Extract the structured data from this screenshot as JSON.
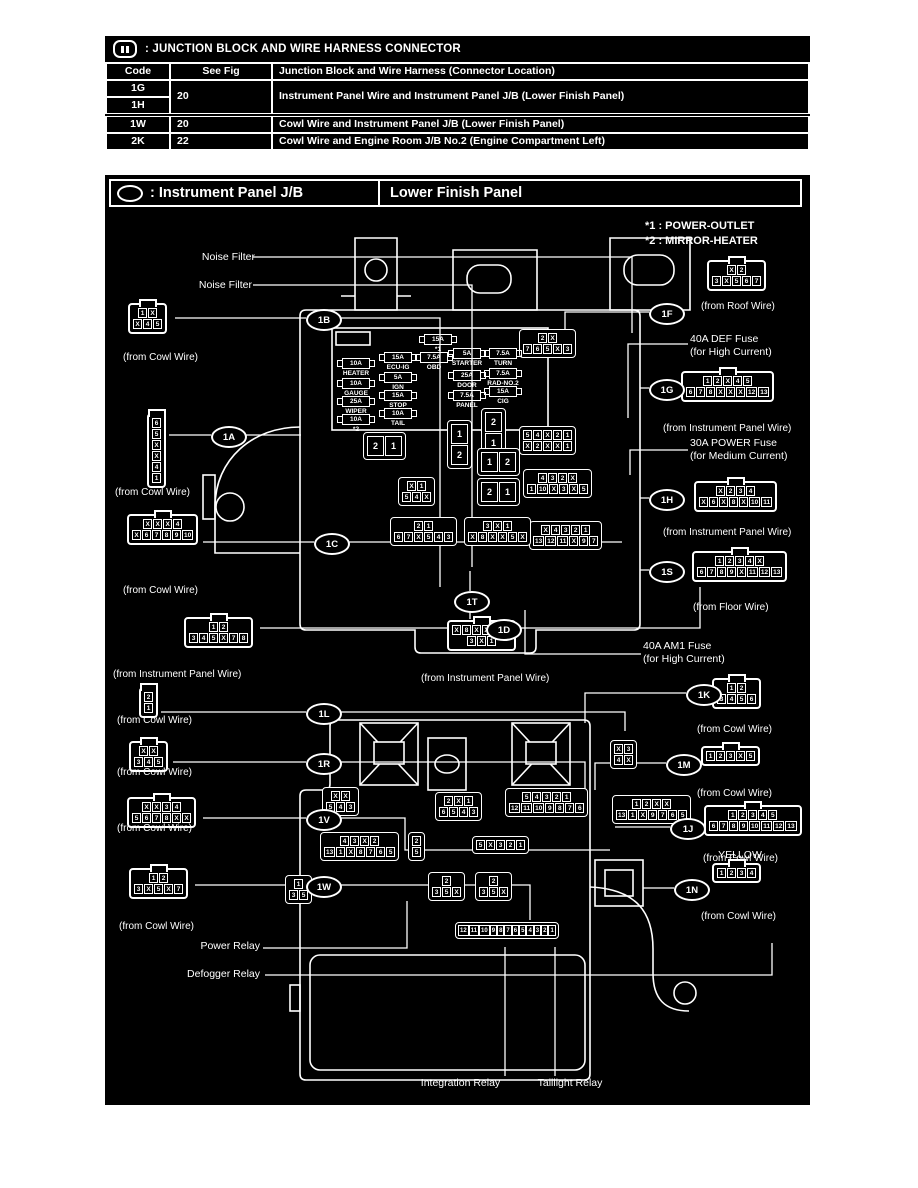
{
  "header": {
    "icon": "junction-block-icon",
    "title": ": JUNCTION BLOCK AND WIRE HARNESS CONNECTOR"
  },
  "table": {
    "headers": [
      "Code",
      "See Fig",
      "Junction Block and Wire Harness (Connector Location)"
    ],
    "g": {
      "code": "1G"
    },
    "h": {
      "code": "1H"
    },
    "gh": {
      "fig": "20",
      "desc": "Instrument Panel Wire and Instrument Panel J/B (Lower Finish Panel)"
    },
    "w": {
      "code": "1W",
      "fig": "20",
      "desc": "Cowl Wire and Instrument Panel J/B (Lower Finish Panel)"
    },
    "k": {
      "code": "2K",
      "fig": "22",
      "desc": "Cowl Wire and Engine Room J/B No.2 (Engine Compartment Left)"
    }
  },
  "diagram": {
    "icon": "instrument-panel-jb-icon",
    "title_left": ": Instrument Panel J/B",
    "title_right": "Lower Finish Panel",
    "notes": [
      "*1 : POWER-OUTLET",
      "*2 : MIRROR-HEATER"
    ],
    "colors": {
      "background": "#000000",
      "foreground": "#ffffff"
    },
    "fuses": [
      {
        "id": "heater",
        "amp": "10A",
        "name": "HEATER"
      },
      {
        "id": "gauge",
        "amp": "10A",
        "name": "GAUGE"
      },
      {
        "id": "wiper",
        "amp": "25A",
        "name": "WIPER"
      },
      {
        "id": "mirror",
        "amp": "10A",
        "name": "*2"
      },
      {
        "id": "ecuig",
        "amp": "15A",
        "name": "ECU-IG"
      },
      {
        "id": "ign",
        "amp": "5A",
        "name": "IGN"
      },
      {
        "id": "stop",
        "amp": "15A",
        "name": "STOP"
      },
      {
        "id": "tail",
        "amp": "10A",
        "name": "TAIL"
      },
      {
        "id": "outlet",
        "amp": "15A",
        "name": "*1"
      },
      {
        "id": "obd",
        "amp": "7.5A",
        "name": "OBD"
      },
      {
        "id": "starter",
        "amp": "5A",
        "name": "STARTER"
      },
      {
        "id": "door",
        "amp": "25A",
        "name": "DOOR"
      },
      {
        "id": "panel",
        "amp": "7.5A",
        "name": "PANEL"
      },
      {
        "id": "turn",
        "amp": "7.5A",
        "name": "TURN"
      },
      {
        "id": "radno2",
        "amp": "7.5A",
        "name": "RAD-NO.2"
      },
      {
        "id": "cig",
        "amp": "15A",
        "name": "CIG"
      }
    ],
    "callouts": [
      "1A",
      "1B",
      "1C",
      "1D",
      "1T",
      "1L",
      "1R",
      "1V",
      "1W",
      "1F",
      "1G",
      "1H",
      "1S",
      "1K",
      "1M",
      "1J",
      "1N"
    ],
    "connectors": [
      {
        "id": "c1B",
        "callout": "1B",
        "rows": [
          [
            "1",
            "X"
          ],
          [
            "X",
            "4",
            "5"
          ]
        ],
        "from": "(from Cowl Wire)"
      },
      {
        "id": "c1A",
        "callout": "1A",
        "rows": [
          [
            "6"
          ],
          [
            "5"
          ],
          [
            "X"
          ],
          [
            "X"
          ],
          [
            "4"
          ],
          [
            "1"
          ]
        ],
        "from": "(from Cowl Wire)"
      },
      {
        "id": "c1C",
        "callout": "1C",
        "rows": [
          [
            "X",
            "X",
            "X",
            "4"
          ],
          [
            "X",
            "6",
            "7",
            "8",
            "9",
            "10"
          ]
        ],
        "from": "(from Cowl Wire)"
      },
      {
        "id": "c1D",
        "callout": "1D",
        "rows": [
          [
            "1",
            "2"
          ],
          [
            "3",
            "4",
            "5",
            "X",
            "7",
            "8"
          ]
        ],
        "from": "(from Instrument Panel Wire)"
      },
      {
        "id": "c1T",
        "callout": "1T",
        "rows": [
          [
            "X",
            "8",
            "X",
            "X",
            "5",
            "X"
          ],
          [
            "3",
            "X",
            "1"
          ]
        ],
        "from": "(from Instrument Panel Wire)"
      },
      {
        "id": "c1L",
        "callout": "1L",
        "rows": [
          [
            "2"
          ],
          [
            "1"
          ]
        ],
        "from": "(from Cowl Wire)"
      },
      {
        "id": "c1R",
        "callout": "1R",
        "rows": [
          [
            "X",
            "X"
          ],
          [
            "3",
            "4",
            "5"
          ]
        ],
        "from": "(from Cowl Wire)"
      },
      {
        "id": "c1V",
        "callout": "1V",
        "rows": [
          [
            "X",
            "X",
            "3",
            "4"
          ],
          [
            "5",
            "6",
            "7",
            "8",
            "X",
            "X"
          ]
        ],
        "from": "(from Cowl Wire)"
      },
      {
        "id": "c1W",
        "callout": "1W",
        "rows": [
          [
            "1",
            "2"
          ],
          [
            "3",
            "X",
            "5",
            "X",
            "7"
          ]
        ],
        "from": "(from Cowl Wire)"
      },
      {
        "id": "c1F",
        "callout": "1F",
        "rows": [
          [
            "X",
            "2"
          ],
          [
            "3",
            "X",
            "5",
            "6",
            "7"
          ]
        ],
        "from": "(from Roof Wire)"
      },
      {
        "id": "c1G",
        "callout": "1G",
        "rows": [
          [
            "1",
            "2",
            "X",
            "4",
            "5"
          ],
          [
            "6",
            "7",
            "8",
            "X",
            "X",
            "X",
            "12",
            "13"
          ]
        ],
        "from": "(from Instrument Panel Wire)"
      },
      {
        "id": "c1H",
        "callout": "1H",
        "rows": [
          [
            "X",
            "2",
            "3",
            "4"
          ],
          [
            "X",
            "6",
            "X",
            "8",
            "X",
            "10",
            "11"
          ]
        ],
        "from": "(from Instrument Panel Wire)"
      },
      {
        "id": "c1S",
        "callout": "1S",
        "rows": [
          [
            "1",
            "2",
            "3",
            "4",
            "X"
          ],
          [
            "6",
            "7",
            "8",
            "9",
            "X",
            "11",
            "12",
            "13"
          ]
        ],
        "from": "(from Floor Wire)"
      },
      {
        "id": "c1K",
        "callout": "1K",
        "rows": [
          [
            "1",
            "2"
          ],
          [
            "3",
            "4",
            "5",
            "6"
          ]
        ],
        "from": "(from Cowl Wire)"
      },
      {
        "id": "c1M",
        "callout": "1M",
        "rows": [
          [
            "1",
            "2",
            "3",
            "X",
            "5"
          ]
        ],
        "from": "(from Cowl Wire)"
      },
      {
        "id": "c1J",
        "callout": "1J",
        "rows": [
          [
            "1",
            "2",
            "3",
            "4",
            "5"
          ],
          [
            "6",
            "7",
            "8",
            "9",
            "10",
            "11",
            "12",
            "13"
          ]
        ],
        "from": "(from Cowl Wire)"
      },
      {
        "id": "c1N",
        "callout": "1N",
        "rows": [
          [
            "1",
            "2",
            "3",
            "4"
          ]
        ],
        "from": "(from Cowl Wire)"
      },
      {
        "id": "u1",
        "rows": [
          [
            "2",
            "X"
          ],
          [
            "7",
            "6",
            "5",
            "X",
            "3"
          ]
        ]
      },
      {
        "id": "u2",
        "rows": [
          [
            "5",
            "4",
            "X",
            "2",
            "1"
          ],
          [
            "X",
            "2",
            "X",
            "X",
            "1"
          ]
        ]
      },
      {
        "id": "u3",
        "rows": [
          [
            "4",
            "3",
            "2",
            "X"
          ],
          [
            "1",
            "10",
            "X",
            "3",
            "X",
            "5"
          ]
        ]
      },
      {
        "id": "u4",
        "rows": [
          [
            "X",
            "4",
            "3",
            "2",
            "1"
          ],
          [
            "13",
            "12",
            "11",
            "X",
            "9",
            "7"
          ]
        ]
      },
      {
        "id": "u5",
        "rows": [
          [
            "X",
            "1"
          ],
          [
            "5",
            "4",
            "X"
          ]
        ]
      },
      {
        "id": "u6",
        "rows": [
          [
            "2",
            "1"
          ],
          [
            "6",
            "7",
            "X",
            "5",
            "4",
            "3"
          ]
        ]
      },
      {
        "id": "u7",
        "rows": [
          [
            "3",
            "X",
            "1"
          ],
          [
            "X",
            "8",
            "X",
            "X",
            "5",
            "X"
          ]
        ]
      },
      {
        "id": "l1",
        "rows": [
          [
            "X",
            "X"
          ],
          [
            "5",
            "4",
            "3"
          ]
        ]
      },
      {
        "id": "l2",
        "rows": [
          [
            "4",
            "3",
            "X",
            "2"
          ],
          [
            "13",
            "1",
            "X",
            "8",
            "7",
            "6",
            "5"
          ]
        ]
      },
      {
        "id": "l3",
        "rows": [
          [
            "2",
            "X",
            "1"
          ],
          [
            "6",
            "5",
            "4",
            "3"
          ]
        ]
      },
      {
        "id": "l4",
        "rows": [
          [
            "5",
            "4",
            "3",
            "2",
            "1"
          ],
          [
            "12",
            "11",
            "10",
            "9",
            "8",
            "7",
            "6"
          ]
        ]
      },
      {
        "id": "l5",
        "rows": [
          [
            "2"
          ],
          [
            "5"
          ]
        ]
      },
      {
        "id": "l6",
        "rows": [
          [
            "5",
            "X",
            "3",
            "2",
            "1"
          ]
        ]
      },
      {
        "id": "l7",
        "rows": [
          [
            "X",
            "3"
          ],
          [
            "4",
            "X"
          ]
        ]
      },
      {
        "id": "l8",
        "rows": [
          [
            "1",
            "2",
            "X",
            "X"
          ],
          [
            "13",
            "1",
            "X",
            "9",
            "7",
            "6",
            "5"
          ]
        ]
      },
      {
        "id": "b1",
        "rows": [
          [
            "1"
          ],
          [
            "3",
            "5"
          ]
        ]
      },
      {
        "id": "b2",
        "rows": [
          [
            "2"
          ],
          [
            "3",
            "5",
            "X"
          ]
        ]
      },
      {
        "id": "b3",
        "rows": [
          [
            "2"
          ],
          [
            "3",
            "5",
            "X"
          ]
        ]
      },
      {
        "id": "strip",
        "size": "xs",
        "rows": [
          [
            "12",
            "11",
            "10",
            "9",
            "8",
            "7",
            "6",
            "5",
            "4",
            "3",
            "2",
            "1"
          ]
        ]
      },
      {
        "id": "r1",
        "size": "lg",
        "rows": [
          [
            "2",
            "1"
          ]
        ]
      },
      {
        "id": "r2",
        "size": "lg",
        "rows": [
          [
            "1"
          ],
          [
            "2"
          ]
        ]
      },
      {
        "id": "r3",
        "size": "lg",
        "rows": [
          [
            "2"
          ],
          [
            "1"
          ]
        ]
      },
      {
        "id": "r4",
        "size": "lg",
        "rows": [
          [
            "1",
            "2"
          ]
        ]
      },
      {
        "id": "r5",
        "size": "lg",
        "rows": [
          [
            "2",
            "1"
          ]
        ]
      }
    ],
    "labels": [
      {
        "id": "nf1",
        "lines": [
          "Noise Filter"
        ]
      },
      {
        "id": "nf2",
        "lines": [
          "Noise Filter"
        ]
      },
      {
        "id": "def",
        "lines": [
          "40A DEF Fuse",
          "(for High Current)"
        ]
      },
      {
        "id": "power",
        "lines": [
          "30A POWER Fuse",
          "(for Medium Current)"
        ]
      },
      {
        "id": "am1",
        "lines": [
          "40A AM1 Fuse",
          "(for High Current)"
        ]
      },
      {
        "id": "yellow",
        "lines": [
          "YELLOW"
        ]
      },
      {
        "id": "power-relay",
        "lines": [
          "Power Relay"
        ]
      },
      {
        "id": "defogger-relay",
        "lines": [
          "Defogger Relay"
        ]
      },
      {
        "id": "integration-relay",
        "lines": [
          "Integration Relay"
        ]
      },
      {
        "id": "taillight-relay",
        "lines": [
          "Taillight Relay"
        ]
      }
    ]
  }
}
